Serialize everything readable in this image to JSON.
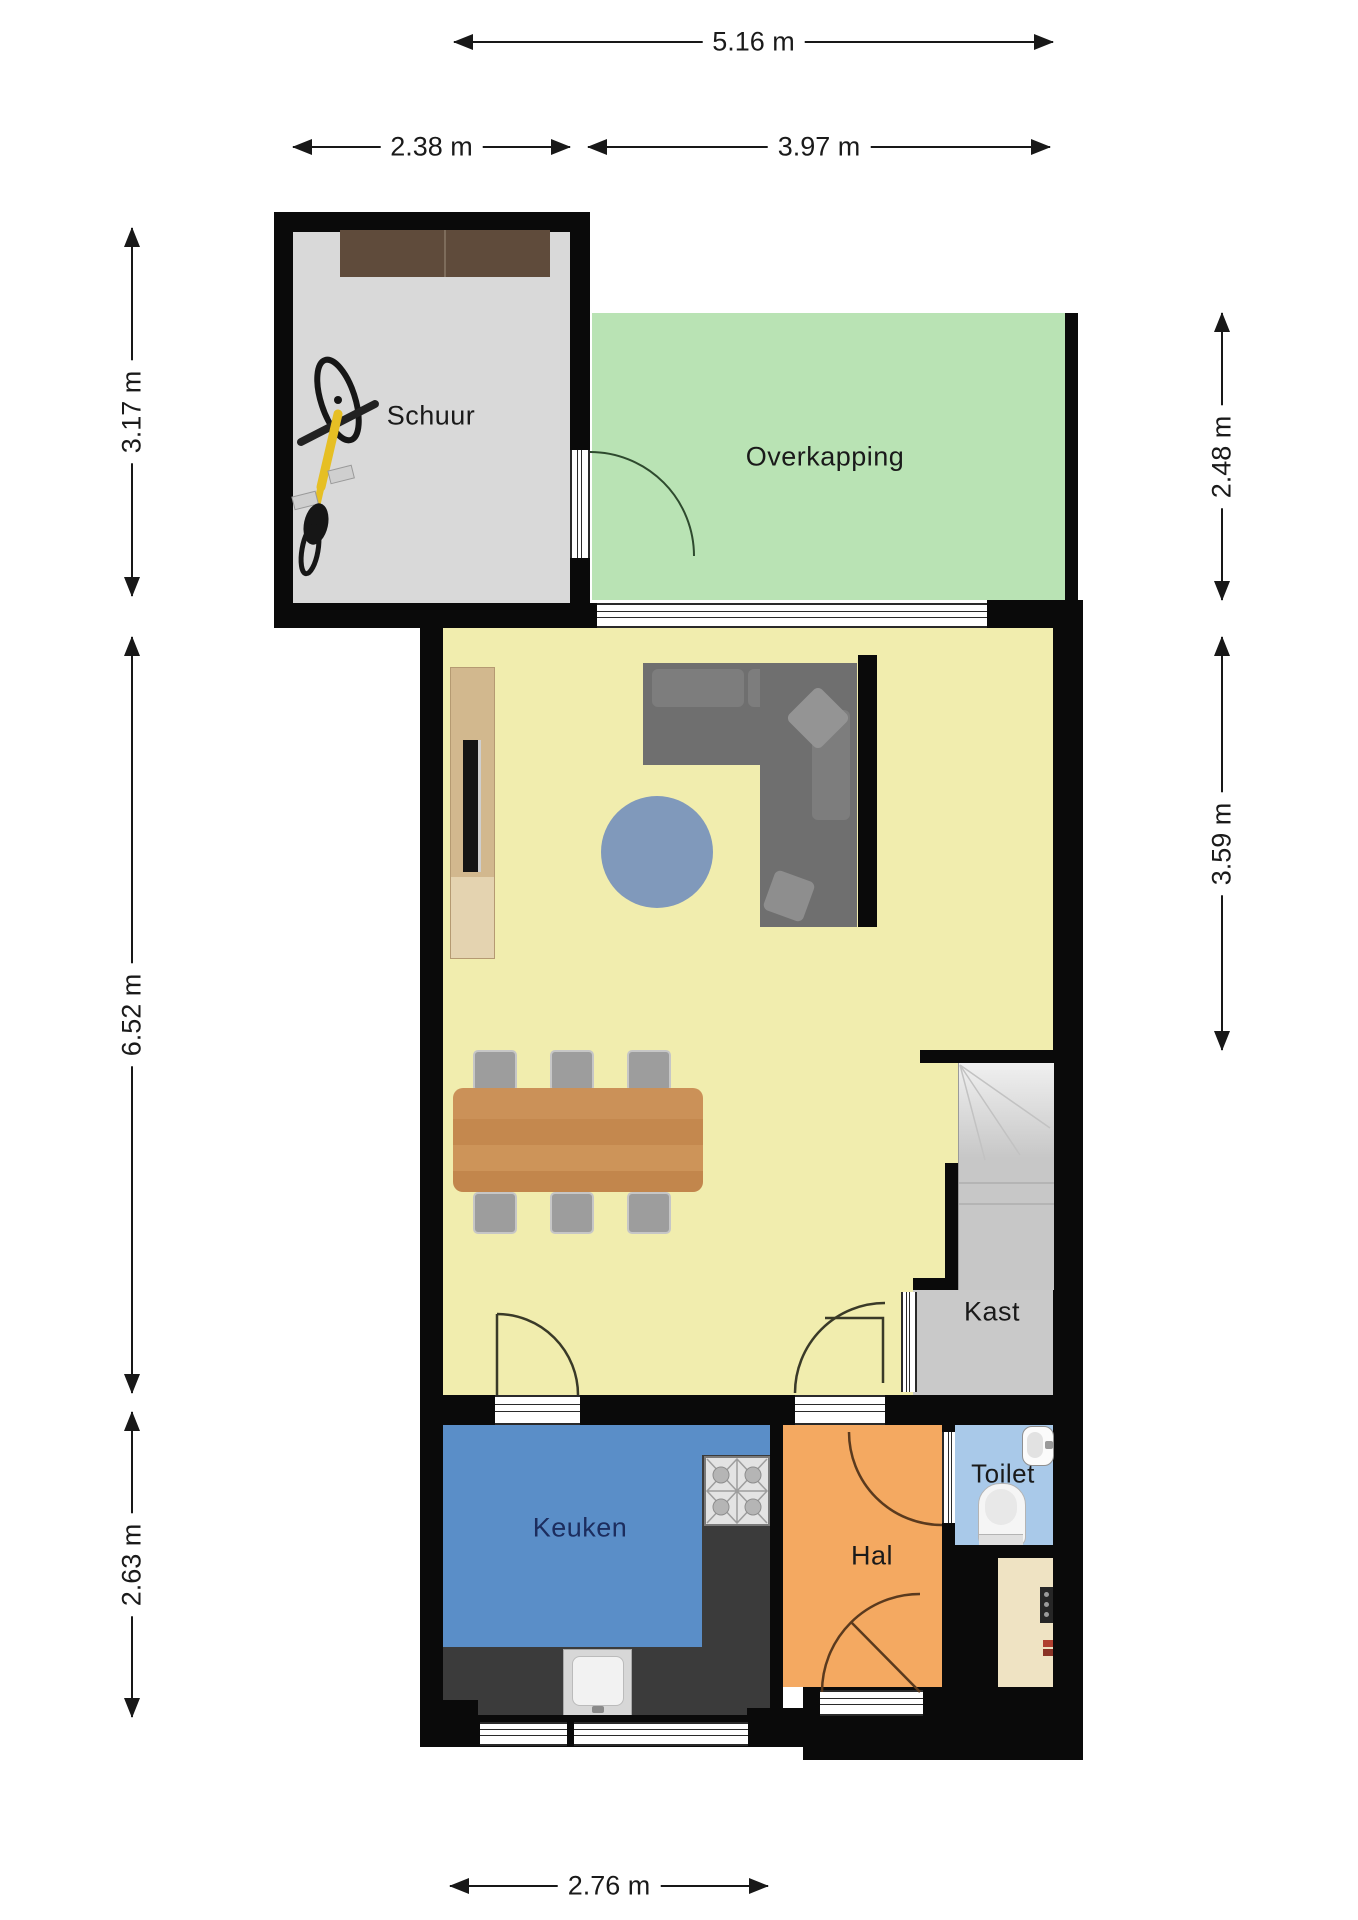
{
  "rooms": {
    "schuur": {
      "label": "Schuur"
    },
    "overkapping": {
      "label": "Overkapping"
    },
    "kast": {
      "label": "Kast"
    },
    "keuken": {
      "label": "Keuken"
    },
    "hal": {
      "label": "Hal"
    },
    "toilet": {
      "label": "Toilet"
    }
  },
  "dimensions": {
    "total_width_top": "5.16 m",
    "schuur_width": "2.38 m",
    "overkapping_width": "3.97 m",
    "schuur_depth": "3.17 m",
    "living_depth": "6.52 m",
    "keuken_depth": "2.63 m",
    "overkapping_depth": "2.48 m",
    "living_right_depth": "3.59 m",
    "keuken_width_bottom": "2.76 m"
  },
  "furniture": [
    "bicycle",
    "storage-shelf",
    "tv-cabinet",
    "tv",
    "corner-sofa",
    "round-rug",
    "dining-table",
    "dining-chairs",
    "stove",
    "kitchen-sink",
    "kitchen-counter",
    "staircase",
    "toilet-bowl",
    "washbasin",
    "electrical-panel"
  ],
  "colors": {
    "wall": "#0a0a0a",
    "schuur_floor": "#d9d9d9",
    "overkapping_floor": "#b9e3b4",
    "living_floor": "#f1edae",
    "keuken_floor": "#5a8ec8",
    "hal_floor": "#f4a961",
    "toilet_floor": "#a9c9e9",
    "kast_floor": "#c9c9c9",
    "meterkast_floor": "#efe3c3",
    "counter": "#3b3b3b",
    "dining_table": "#c98e55",
    "sofa": "#6f6f6f",
    "rug": "#8099bb",
    "keuken_label_color": "#1c2d5e"
  }
}
